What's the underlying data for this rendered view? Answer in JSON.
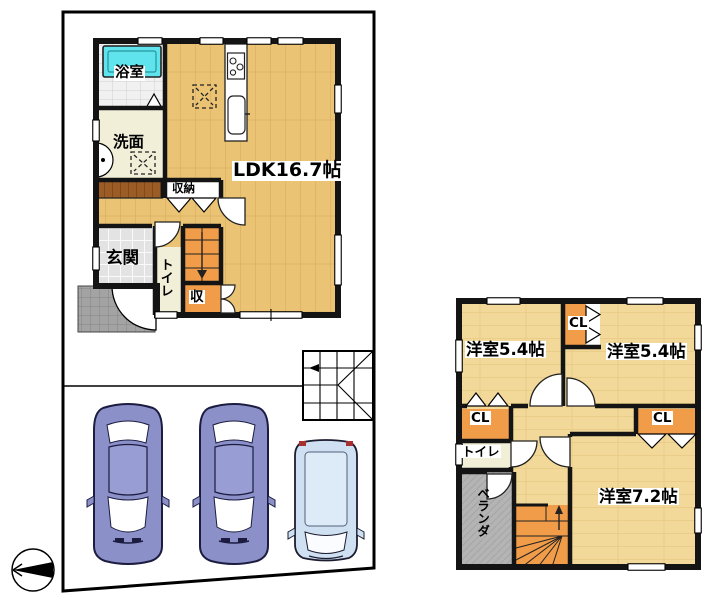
{
  "plan": {
    "floor1": {
      "labels": {
        "ldk": "LDK16.7帖",
        "bath": "浴室",
        "washroom": "洗面",
        "entrance": "玄関",
        "toilet": "トイレ",
        "storage": "収納",
        "storage_small": "収"
      }
    },
    "floor2": {
      "labels": {
        "bedroom_left": "洋室5.4帖",
        "bedroom_right": "洋室5.4帖",
        "bedroom_large": "洋室7.2帖",
        "closet_top": "CL",
        "closet_left": "CL",
        "closet_right": "CL",
        "toilet": "トイレ",
        "veranda": "ベランダ"
      }
    },
    "site": {
      "parking_car_count": 3,
      "compass_direction": "north-left"
    },
    "colors": {
      "floor_wood_1f": "#eac474",
      "floor_wood_2f": "#f2d899",
      "closet_orange": "#f09c48",
      "toilet_cream": "#f2efd8",
      "bathtub_cyan": "#5fe4ee",
      "veranda_gray": "#b4b4b4",
      "car_body_blue": "#8b90c9",
      "car_body_light": "#cfe0f2"
    }
  }
}
